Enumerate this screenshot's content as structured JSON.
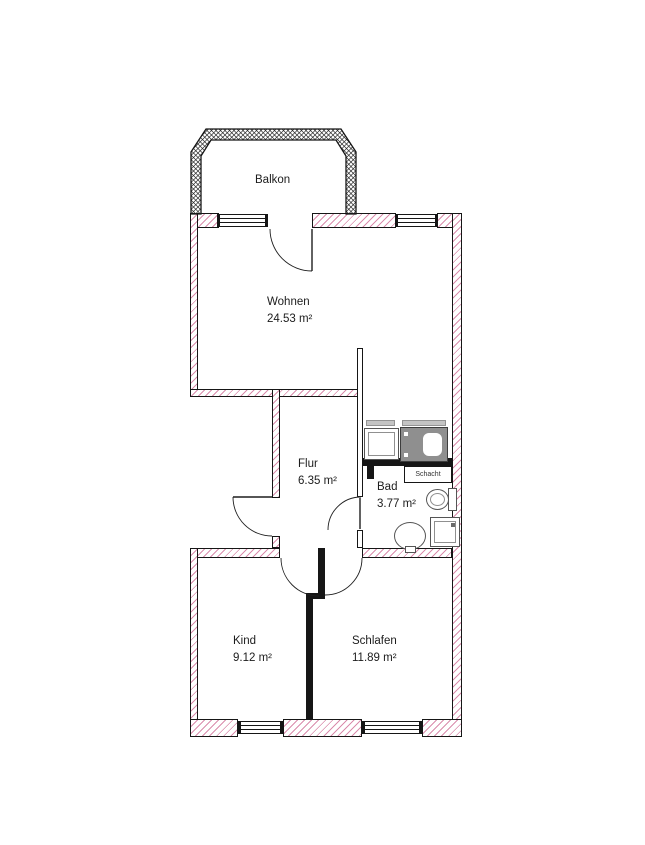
{
  "plan": {
    "rooms": [
      {
        "label": "Balkon",
        "area": ""
      },
      {
        "label": "Wohnen",
        "area": "24.53 m²"
      },
      {
        "label": "Flur",
        "area": "6.35 m²"
      },
      {
        "label": "Bad",
        "area": "3.77 m²"
      },
      {
        "label": "Kind",
        "area": "9.12 m²"
      },
      {
        "label": "Schlafen",
        "area": "11.89 m²"
      }
    ],
    "shaft_label": "Schacht",
    "fixture_icons": [
      "washing-machine",
      "bathtub",
      "toilet",
      "washbasin",
      "shower-tray"
    ],
    "colors": {
      "background": "#ffffff",
      "wall_hatch_pink": "#d3789e",
      "wall_outline": "#161616",
      "balcony_crosshatch": "#2a2a2a",
      "bathtub_fill": "#8f8f8f",
      "fixture_outline": "#555555"
    }
  }
}
